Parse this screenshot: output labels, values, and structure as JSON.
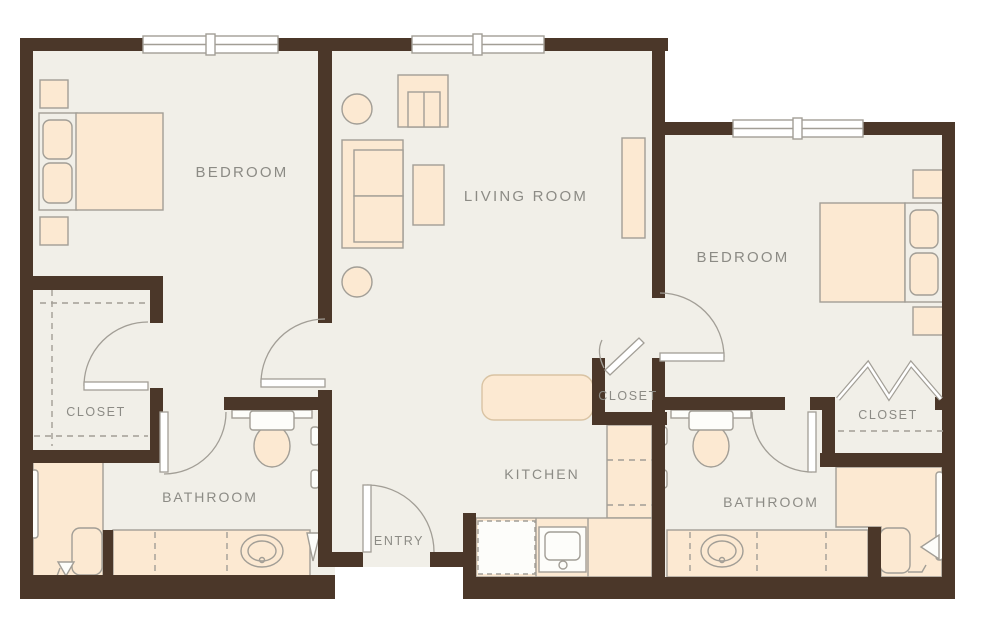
{
  "plan": {
    "type": "floor-plan",
    "unit": "two-bedroom two-bathroom apartment"
  },
  "palette": {
    "wall": "#4b3729",
    "floor": "#f1efe8",
    "furniture": "#fce9d2",
    "outline": "#a29e96",
    "island_outline": "#d9c3a3",
    "label": "#8c8b85",
    "white": "#ffffff"
  },
  "rooms": {
    "bedroom_left": {
      "label": "BEDROOM"
    },
    "living_room": {
      "label": "LIVING ROOM"
    },
    "bedroom_right": {
      "label": "BEDROOM"
    },
    "closet_left": {
      "label": "CLOSET"
    },
    "closet_center": {
      "label": "CLOSET"
    },
    "closet_right": {
      "label": "CLOSET"
    },
    "bathroom_left": {
      "label": "BATHROOM"
    },
    "kitchen": {
      "label": "KITCHEN"
    },
    "bathroom_right": {
      "label": "BATHROOM"
    },
    "entry": {
      "label": "ENTRY"
    }
  },
  "fixtures": [
    "bed",
    "pillows",
    "nightstand",
    "sofa",
    "coffee-table",
    "tv-cabinet",
    "plant",
    "console-table",
    "kitchen-island",
    "kitchen-sink",
    "dishwasher",
    "counter",
    "toilet",
    "vanity-sink",
    "walk-in-shower",
    "shower-bench",
    "grab-bar",
    "towel-bar",
    "window",
    "door-swing",
    "bifold-door"
  ],
  "counts": {
    "bedrooms": 2,
    "bathrooms": 2,
    "closets": 3,
    "windows": 3
  }
}
